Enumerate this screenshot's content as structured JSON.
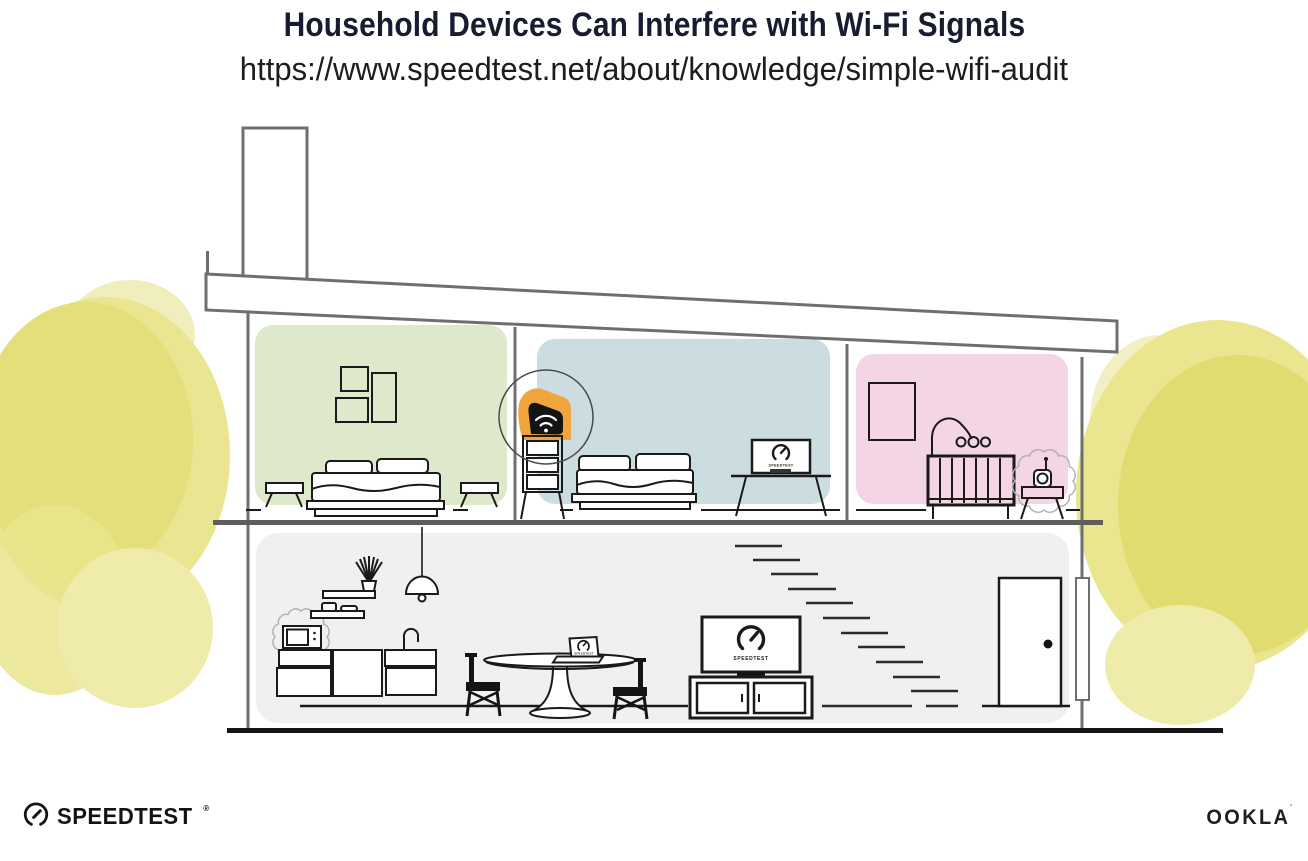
{
  "header": {
    "title": "Household Devices Can Interfere with Wi-Fi Signals",
    "url": "https://www.speedtest.net/about/knowledge/simple-wifi-audit"
  },
  "screens": {
    "tv_label": "SPEEDTEST",
    "monitor_label": "SPEEDTEST",
    "laptop_label": "SPEEDTEST"
  },
  "footer": {
    "speedtest_wordmark": "SPEEDTEST",
    "speedtest_reg": "®",
    "ookla_wordmark": "OOKLA",
    "ookla_mark": "´"
  },
  "icons": {
    "router": "wifi-icon",
    "tv_screen": "speedtest-gauge-icon",
    "monitor_screen": "speedtest-gauge-icon",
    "laptop_screen": "speedtest-gauge-icon",
    "speedtest_logo": "speedtest-gauge-icon"
  },
  "palette": {
    "router_orange": "#f0a43e",
    "room_green": "#dee9cb",
    "room_blue": "#ccdde2",
    "room_pink": "#f3d5e5",
    "floor_gray": "#f1f0ee",
    "bush_yellow": "#e3df7a",
    "structure_gray": "#6f6f6f",
    "ink": "#1a1a1a",
    "title_navy": "#171c30"
  }
}
